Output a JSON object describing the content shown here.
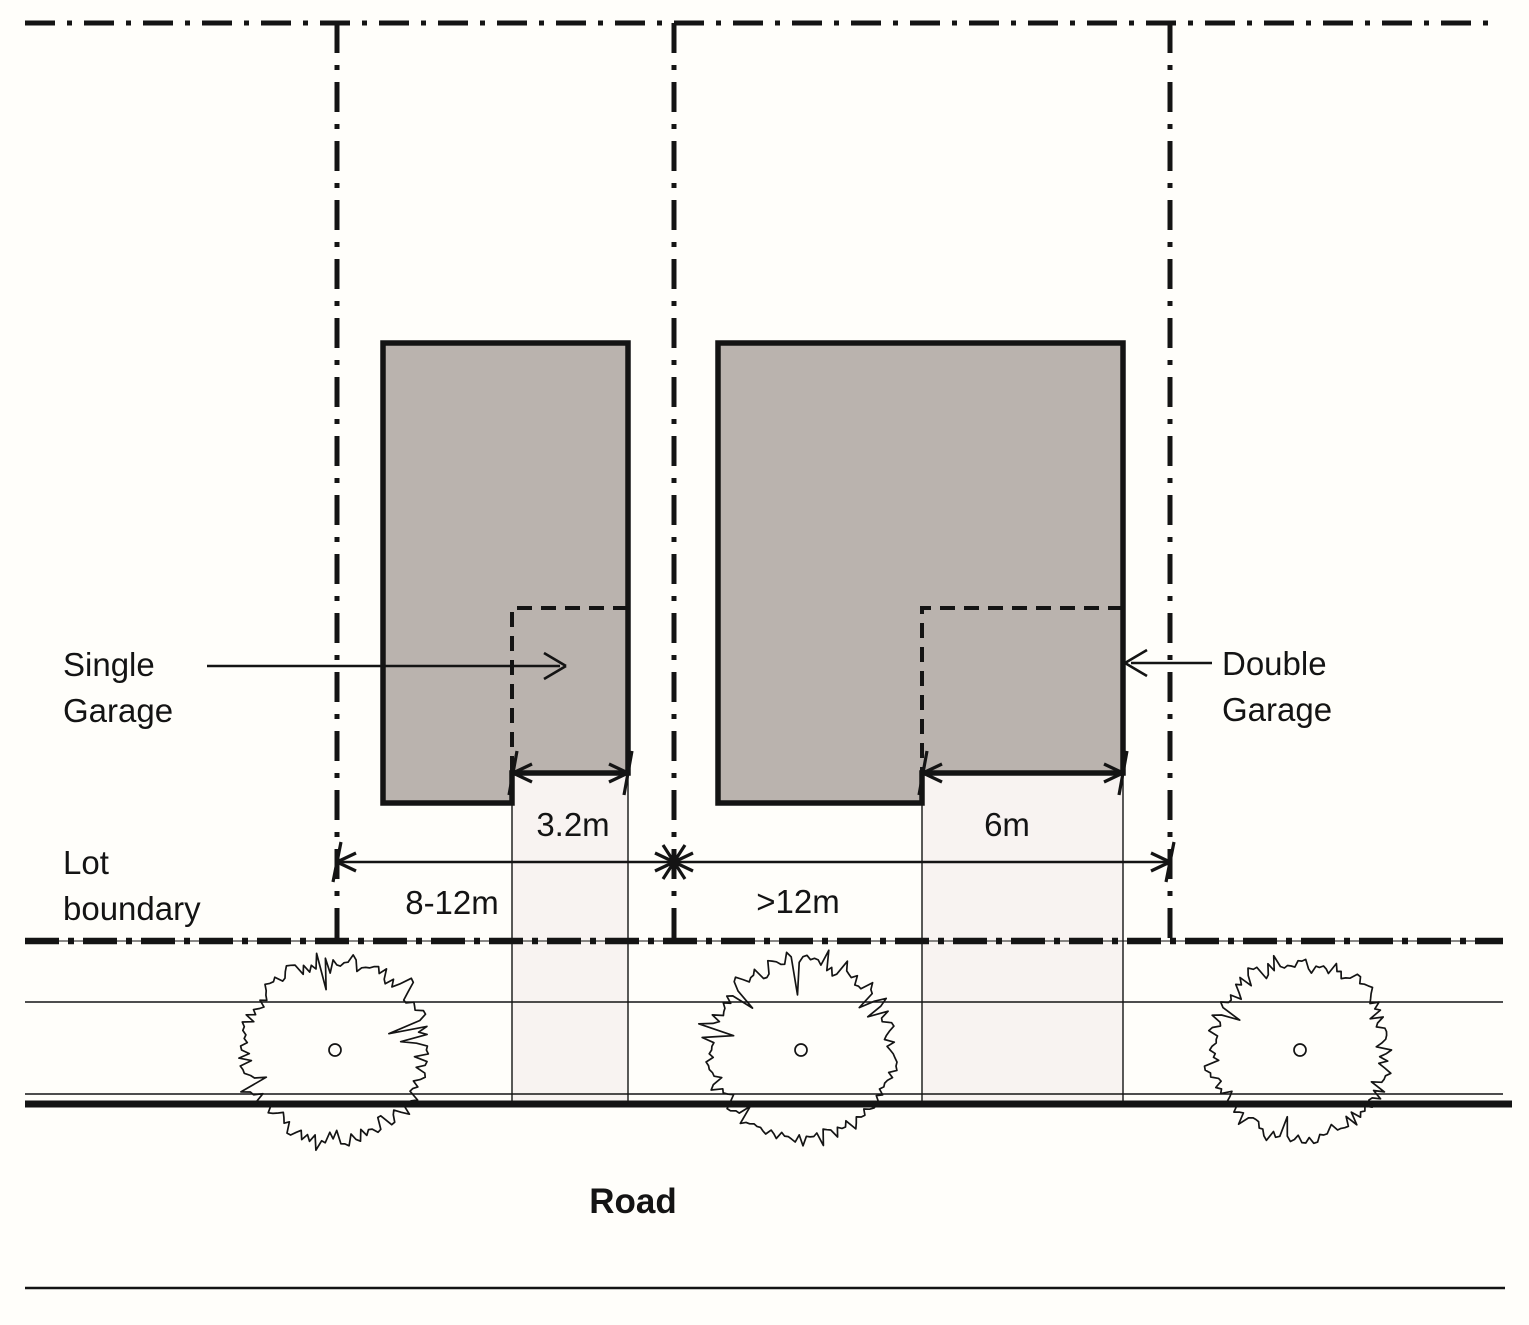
{
  "diagram": {
    "labels": {
      "single_garage": {
        "line1": "Single",
        "line2": "Garage"
      },
      "double_garage": {
        "line1": "Double",
        "line2": "Garage"
      },
      "lot_boundary": {
        "line1": "Lot",
        "line2": "boundary"
      },
      "road": "Road"
    },
    "dimensions": {
      "single_garage_width": "3.2m",
      "double_garage_width": "6m",
      "narrow_lot_frontage": "8-12m",
      "wide_lot_frontage": ">12m"
    },
    "colors": {
      "building_fill": "#bab3ae",
      "driveway_fill": "#f8f3f1",
      "line": "#141414",
      "background": "#fffefa"
    },
    "icons": {
      "tree": "tree-icon",
      "tree_count": 3
    }
  }
}
